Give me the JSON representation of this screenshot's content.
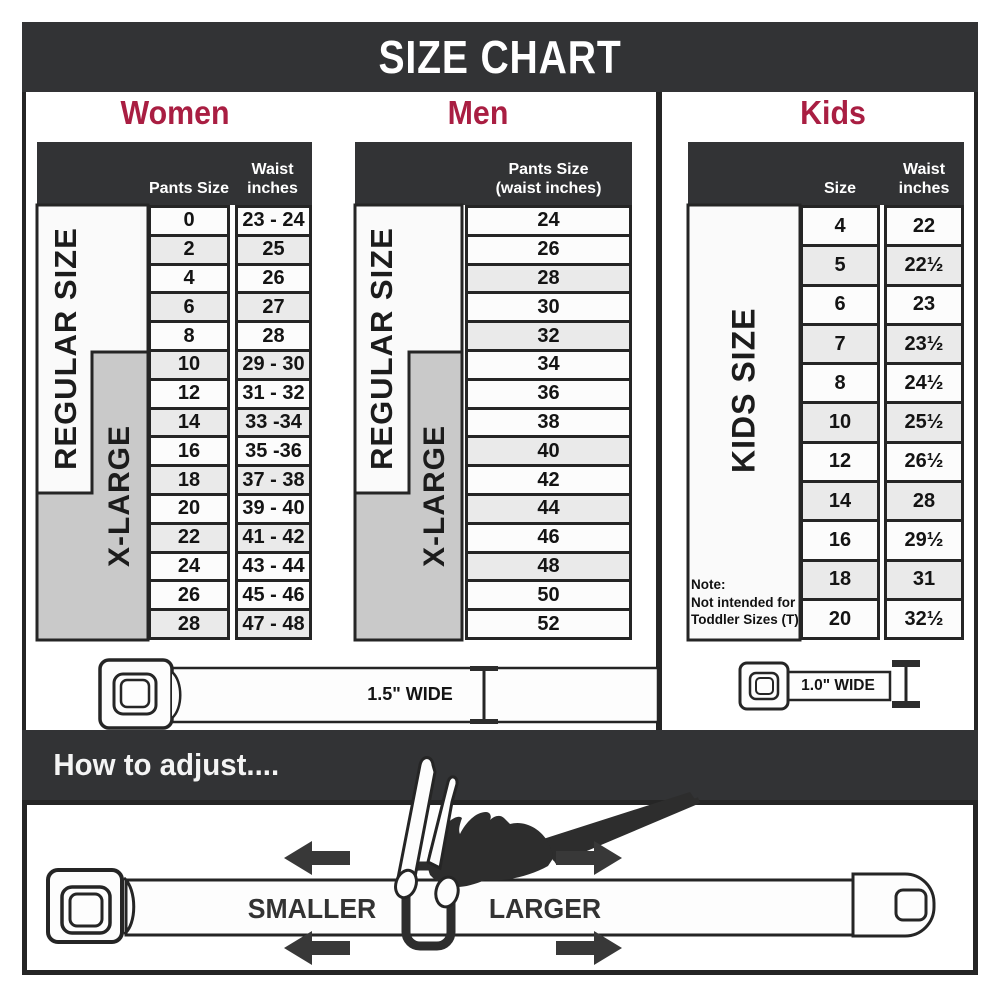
{
  "title": "SIZE CHART",
  "colors": {
    "banner_bg": "#323335",
    "accent_red": "#a91e42",
    "border_dark": "#252525",
    "row_shaded": "#eaeaea",
    "row_plain": "#fcfcfc",
    "xlarge_gray": "#c9c9c9",
    "label_box_bg": "#fafafa"
  },
  "women": {
    "heading": "Women",
    "size_header": "Pants Size",
    "waist_header_lines": [
      "Waist",
      "inches"
    ],
    "regular_label": "REGULAR SIZE",
    "xlarge_label": "X-LARGE",
    "belt_width_label": "1.5\" WIDE",
    "rows": [
      {
        "size": "0",
        "waist": "23 - 24",
        "shaded": false
      },
      {
        "size": "2",
        "waist": "25",
        "shaded": true
      },
      {
        "size": "4",
        "waist": "26",
        "shaded": false
      },
      {
        "size": "6",
        "waist": "27",
        "shaded": true
      },
      {
        "size": "8",
        "waist": "28",
        "shaded": false
      },
      {
        "size": "10",
        "waist": "29 - 30",
        "shaded": true
      },
      {
        "size": "12",
        "waist": "31 - 32",
        "shaded": false
      },
      {
        "size": "14",
        "waist": "33 -34",
        "shaded": true
      },
      {
        "size": "16",
        "waist": "35 -36",
        "shaded": false
      },
      {
        "size": "18",
        "waist": "37 - 38",
        "shaded": true
      },
      {
        "size": "20",
        "waist": "39 - 40",
        "shaded": false
      },
      {
        "size": "22",
        "waist": "41 - 42",
        "shaded": true
      },
      {
        "size": "24",
        "waist": "43 - 44",
        "shaded": false
      },
      {
        "size": "26",
        "waist": "45 - 46",
        "shaded": false
      },
      {
        "size": "28",
        "waist": "47 - 48",
        "shaded": true
      }
    ]
  },
  "men": {
    "heading": "Men",
    "col_header_lines": [
      "Pants Size",
      "(waist inches)"
    ],
    "regular_label": "REGULAR SIZE",
    "xlarge_label": "X-LARGE",
    "rows": [
      {
        "size": "24",
        "shaded": false
      },
      {
        "size": "26",
        "shaded": false
      },
      {
        "size": "28",
        "shaded": true
      },
      {
        "size": "30",
        "shaded": false
      },
      {
        "size": "32",
        "shaded": true
      },
      {
        "size": "34",
        "shaded": false
      },
      {
        "size": "36",
        "shaded": false
      },
      {
        "size": "38",
        "shaded": false
      },
      {
        "size": "40",
        "shaded": true
      },
      {
        "size": "42",
        "shaded": false
      },
      {
        "size": "44",
        "shaded": true
      },
      {
        "size": "46",
        "shaded": false
      },
      {
        "size": "48",
        "shaded": true
      },
      {
        "size": "50",
        "shaded": false
      },
      {
        "size": "52",
        "shaded": false
      }
    ]
  },
  "kids": {
    "heading": "Kids",
    "size_header": "Size",
    "waist_header_lines": [
      "Waist",
      "inches"
    ],
    "label": "KIDS SIZE",
    "note_lines": [
      "Note:",
      "Not intended for",
      "Toddler Sizes (T)"
    ],
    "belt_width_label": "1.0\" WIDE",
    "rows": [
      {
        "size": "4",
        "waist": "22",
        "shaded": false
      },
      {
        "size": "5",
        "waist": "22½",
        "shaded": true
      },
      {
        "size": "6",
        "waist": "23",
        "shaded": false
      },
      {
        "size": "7",
        "waist": "23½",
        "shaded": true
      },
      {
        "size": "8",
        "waist": "24½",
        "shaded": false
      },
      {
        "size": "10",
        "waist": "25½",
        "shaded": true
      },
      {
        "size": "12",
        "waist": "26½",
        "shaded": false
      },
      {
        "size": "14",
        "waist": "28",
        "shaded": true
      },
      {
        "size": "16",
        "waist": "29½",
        "shaded": false
      },
      {
        "size": "18",
        "waist": "31",
        "shaded": true
      },
      {
        "size": "20",
        "waist": "32½",
        "shaded": false
      }
    ]
  },
  "adjust": {
    "heading": "How to adjust....",
    "smaller_label": "SMALLER",
    "larger_label": "LARGER"
  }
}
